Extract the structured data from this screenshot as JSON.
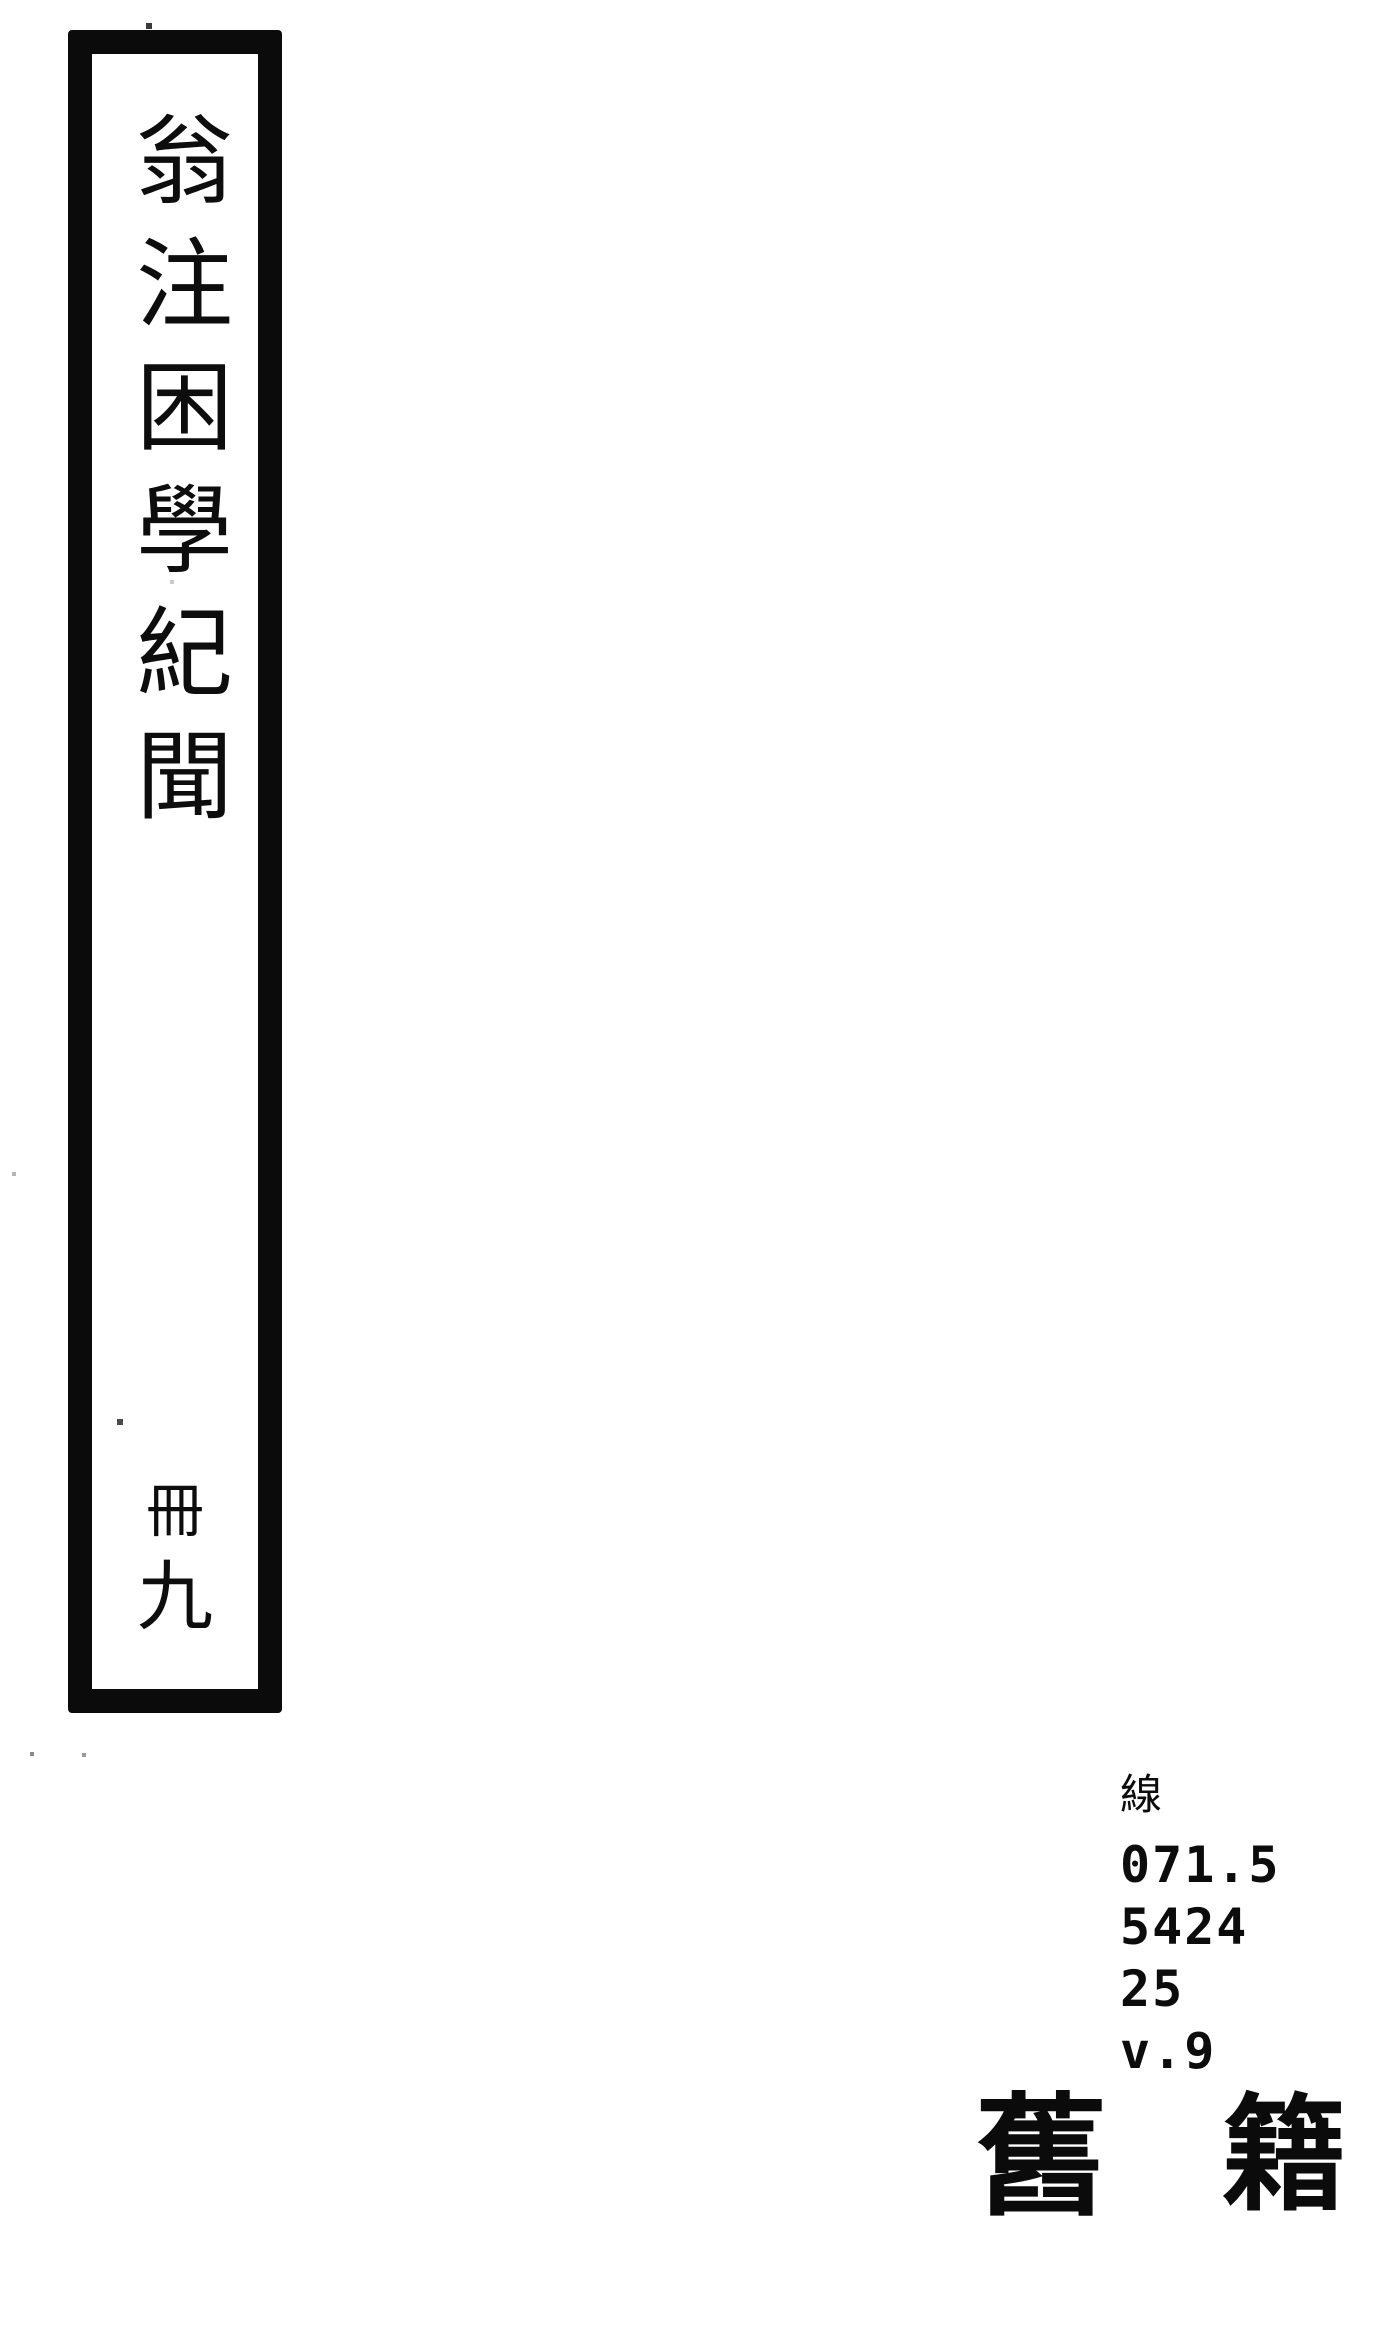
{
  "page": {
    "background": "#ffffff",
    "ink_color": "#0c0c0c"
  },
  "spine": {
    "title_vertical": "翁注困學紀聞",
    "volume": {
      "prefix": "冊",
      "number": "九"
    }
  },
  "call_number": {
    "script_label": "線",
    "lines": [
      "071.5",
      "5424",
      "25",
      "v.9"
    ]
  },
  "category": {
    "left_char": "舊",
    "right_char": "籍"
  }
}
